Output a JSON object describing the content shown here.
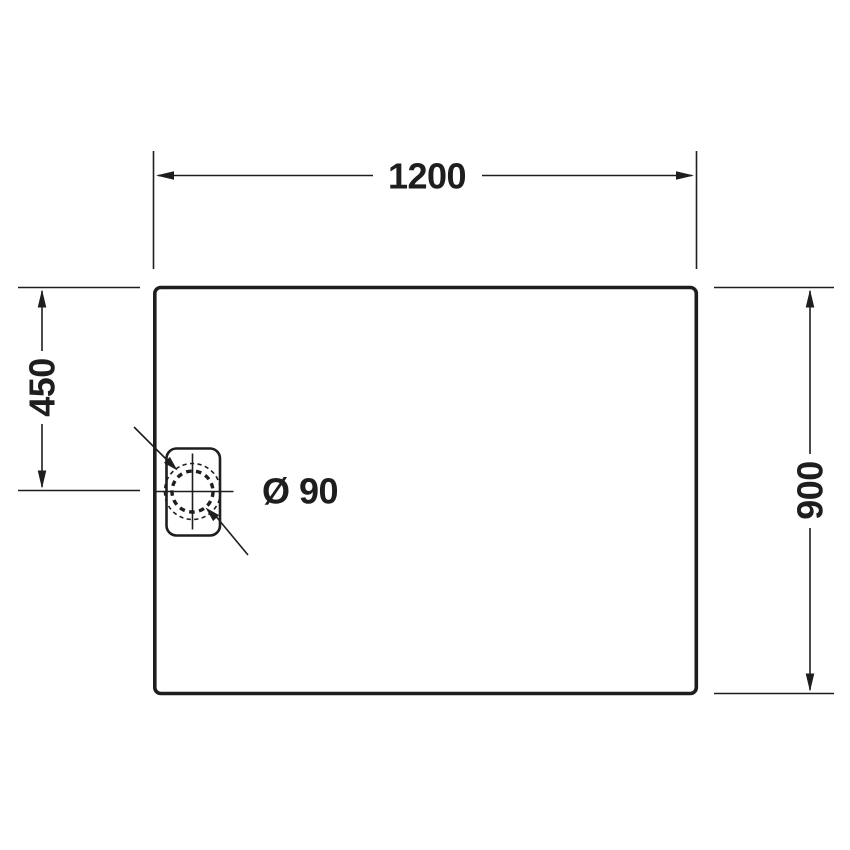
{
  "drawing": {
    "view": "shower-tray-plan-technical-drawing"
  },
  "dimensions": {
    "top_width": {
      "value": "1200"
    },
    "right_height": {
      "value": "900"
    },
    "left_drain_offset": {
      "value": "450"
    },
    "drain_diameter": {
      "value": "Ø 90"
    }
  },
  "colors": {
    "line": "#1e1e1e",
    "background": "#ffffff"
  }
}
